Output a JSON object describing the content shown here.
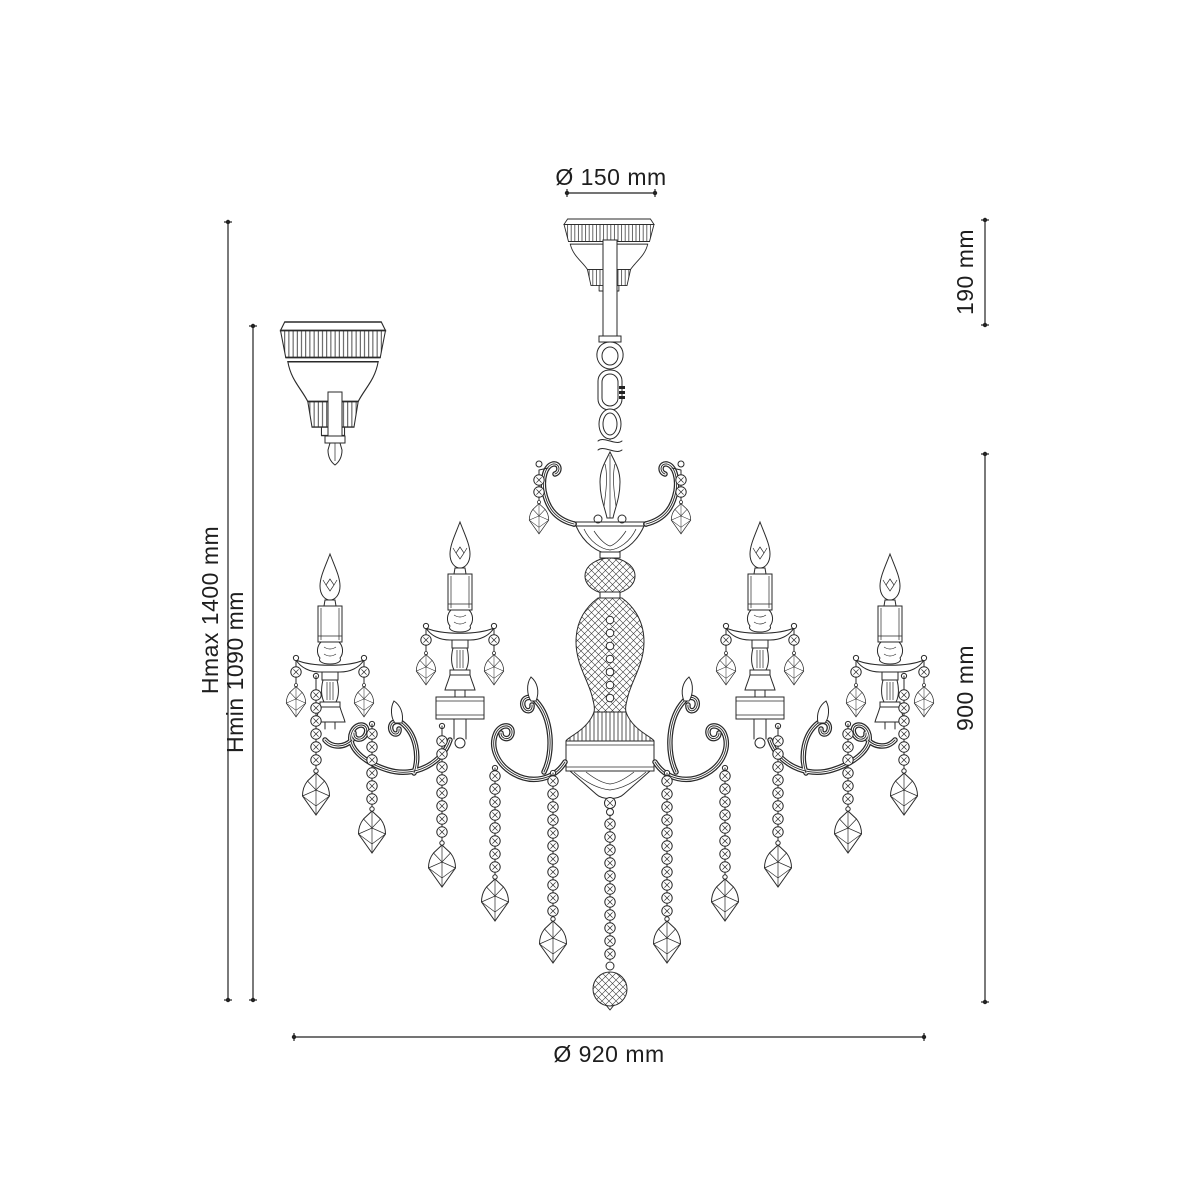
{
  "title": "Chandelier technical dimension drawing",
  "dimensions": {
    "top_diameter": "Ø 150 mm",
    "canopy_height": "190 mm",
    "height_max": "Hmax 1400 mm",
    "height_min": "Hmin 1090 mm",
    "body_height": "900 mm",
    "bottom_diameter": "Ø 920 mm"
  },
  "style": {
    "line_color": "#2a2a2a",
    "background_color": "#ffffff"
  }
}
